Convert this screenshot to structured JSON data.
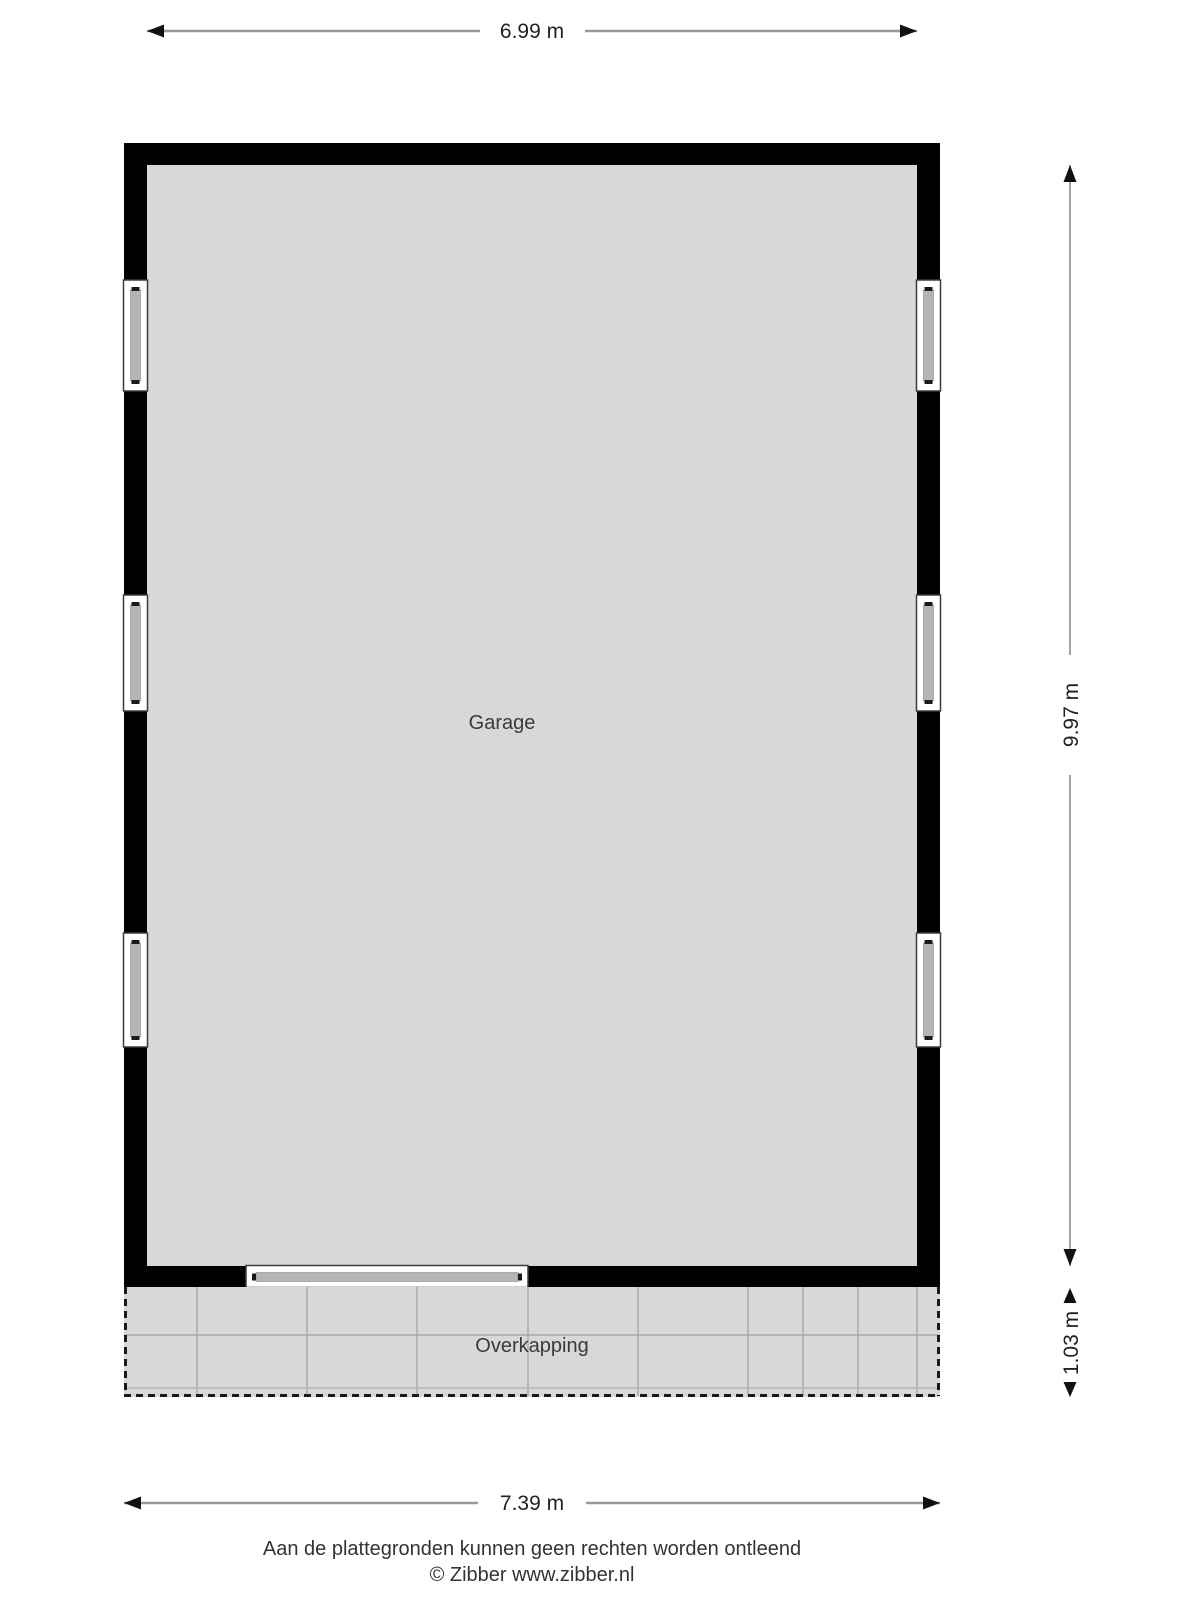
{
  "plan_type": "floor-plan",
  "rooms": [
    {
      "name": "Garage"
    },
    {
      "name": "Overkapping"
    }
  ],
  "dimensions": {
    "top_width": "6.99 m",
    "right_height": "9.97 m",
    "right_lower_height": "1.03 m",
    "bottom_width": "7.39 m"
  },
  "footer": {
    "disclaimer": "Aan de plattegronden kunnen geen rechten worden ontleend",
    "credit": "© Zibber www.zibber.nl"
  },
  "colors": {
    "wall": "#000000",
    "floor": "#d8d8d8",
    "window_frame": "#ffffff",
    "window_glass_bar": "#b5b5b5",
    "grid_line": "#9f9f9f",
    "dimension_line": "#999999",
    "dashed_border": "#1a1a1a",
    "text": "#3a3a3a"
  }
}
